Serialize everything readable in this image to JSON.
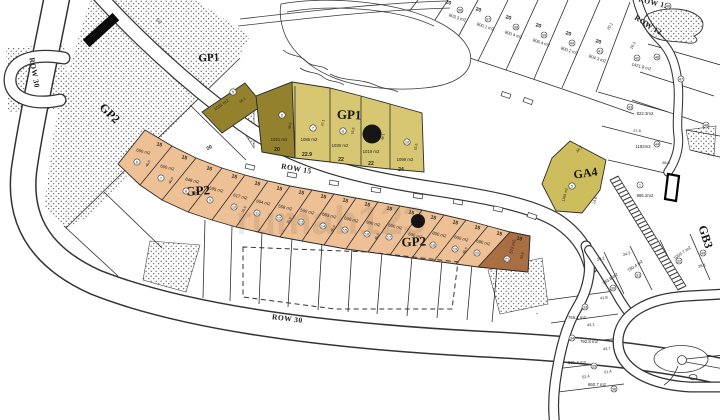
{
  "watermark": "rumah123",
  "colors": {
    "khaki": "#d8c772",
    "olive": "#94812e",
    "salmon": "#eec096",
    "brown": "#aa6e43",
    "ga4": "#cdbd5d"
  },
  "roads": {
    "row30_left": "ROW 30",
    "row30_bottom": "ROW 30",
    "row15": "ROW 15",
    "row12_a": "ROW 12",
    "row12_b": "ROW 12"
  },
  "zones": {
    "gp1_small": "GP1",
    "gp1": "GP1",
    "gp2_left": "GP2",
    "gp2_a": "GP2",
    "gp2_b": "GP2",
    "ga4": "GA4",
    "gb3": "GB3"
  },
  "ga4_lot": {
    "n": "5",
    "area": "1366 m2"
  },
  "gp1_lots": [
    {
      "n": "5",
      "area": "1031 m2",
      "w": "20",
      "d": "55.2"
    },
    {
      "n": "6",
      "area": "1021 m2",
      "w": "20",
      "d": "48.5"
    },
    {
      "n": "7",
      "area": "1085 m2",
      "w": "22.9",
      "d": "47.1"
    },
    {
      "n": "8",
      "area": "1030 m2",
      "w": "22",
      "d": "55.6"
    },
    {
      "n": "",
      "area": "1019 m2",
      "w": "22",
      "d": "48.1"
    },
    {
      "n": "10",
      "area": "1099 m2",
      "w": "24",
      "d": "55.6"
    }
  ],
  "gp2_lots": [
    {
      "n": "6",
      "area": "600 m2",
      "w": "15",
      "d": "40.0"
    },
    {
      "n": "7",
      "area": "600 m2",
      "w": "15",
      "d": "40.0"
    },
    {
      "n": "8",
      "area": "848 m2",
      "w": "16",
      "d": "39.9"
    },
    {
      "n": "9",
      "area": "595 m2",
      "w": "15",
      "d": "39.9"
    },
    {
      "n": "10",
      "area": "617 m2",
      "w": "15",
      "d": "39.9"
    },
    {
      "n": "11",
      "area": "604 m2",
      "w": "15",
      "d": "39.8"
    },
    {
      "n": "12",
      "area": "558 m2",
      "w": "15",
      "d": "39.8"
    },
    {
      "n": "13",
      "area": "599 m2",
      "w": "15",
      "d": "40.0"
    },
    {
      "n": "14",
      "area": "603 m2",
      "w": "15",
      "d": "40.0"
    },
    {
      "n": "15",
      "area": "600 m2",
      "w": "15",
      "d": "40.0"
    },
    {
      "n": "16",
      "area": "600 m2",
      "w": "15",
      "d": "40.0"
    },
    {
      "n": "17",
      "area": "600 m2",
      "w": "15",
      "d": "40.0"
    },
    {
      "n": "",
      "area": "600 m2",
      "w": "15",
      "d": "40.0"
    },
    {
      "n": "18",
      "area": "800 m2",
      "w": "15",
      "d": "40.6"
    },
    {
      "n": "19",
      "area": "600 m2",
      "w": "15",
      "d": "40.6"
    },
    {
      "n": "20",
      "area": "600 m2",
      "w": "15",
      "d": "40.6"
    },
    {
      "n": "21",
      "area": "572 m2",
      "w": "15",
      "d": "33.8"
    }
  ],
  "top_lots": [
    {
      "n": "36",
      "area": "803.3 m2",
      "w": "20"
    },
    {
      "n": "37",
      "area": "800.1 m2",
      "w": "20"
    },
    {
      "n": "38",
      "area": "800.4 m2",
      "w": "20"
    },
    {
      "n": "39",
      "area": "806.4 m2",
      "w": "20"
    },
    {
      "n": "40",
      "area": "800.2 m2",
      "w": "20"
    },
    {
      "n": "41",
      "area": "804.3 m2",
      "w": "20"
    }
  ],
  "right_lots": [
    {
      "n": "42",
      "area": "1421.8 m2"
    },
    {
      "n": "43",
      "area": "822.3m2"
    },
    {
      "n": "44",
      "area": "1192m2"
    },
    {
      "n": "1",
      "area": "986.2m2"
    }
  ],
  "se_lots": [
    {
      "n": "33",
      "area": "766.1 m2"
    },
    {
      "n": "34",
      "area": "792.8 m2"
    },
    {
      "n": "35",
      "area": "831.4 m2"
    },
    {
      "n": "36",
      "area": "860.7 m2"
    }
  ],
  "east_lots": [
    {
      "n": "30",
      "area": "783.6 m2"
    },
    {
      "n": "31",
      "area": "780.4 m2"
    },
    {
      "n": "32",
      "area": "1003.7 m2"
    }
  ],
  "misc_circled": [
    "45",
    "46",
    "47",
    "48",
    "49"
  ],
  "dims": [
    "522",
    "20.1",
    "26.3",
    "27.8",
    "58.0",
    "24.2",
    "14.6",
    "41.8",
    "43.7",
    "51.4",
    "52.4",
    "43.1",
    "23.2",
    "24.3",
    "28.8"
  ]
}
